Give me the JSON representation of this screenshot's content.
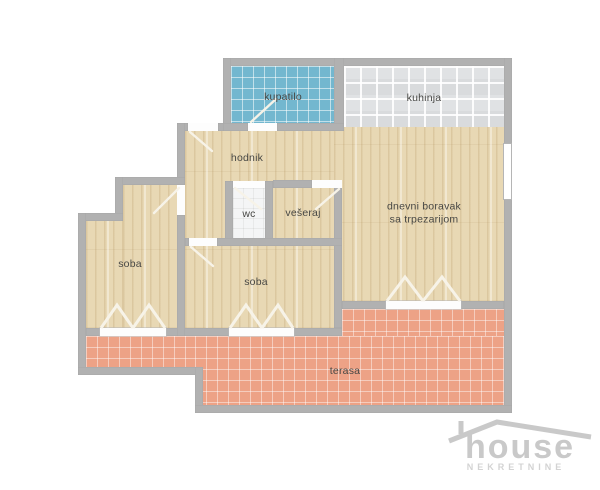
{
  "plan": {
    "rooms": {
      "kupatilo": {
        "label": "kupatilo"
      },
      "kuhinja": {
        "label": "kuhinja"
      },
      "hodnik": {
        "label": "hodnik"
      },
      "wc": {
        "label": "wc"
      },
      "veseraj": {
        "label": "vešeraj"
      },
      "dnevni_boravak": {
        "line1": "dnevni boravak",
        "line2": "sa trpezarijom"
      },
      "soba_levo": {
        "label": "soba"
      },
      "soba_sredina": {
        "label": "soba"
      },
      "terasa": {
        "label": "terasa"
      }
    }
  },
  "logo": {
    "name": "house",
    "subtitle": "NEKRETNINE"
  },
  "colors": {
    "background": "#ffffff",
    "wall": "#b1b1b1",
    "wood_floor": "#e8d8b4",
    "bathroom_tile": "#73b7cf",
    "kitchen_tile": "#e0e2e4",
    "wc_tile": "#f4f5f6",
    "terrace_tile": "#eda286",
    "door_swing": "#f7f3e8",
    "label_text": "#474744",
    "logo_gray": "#c9c9c9"
  }
}
